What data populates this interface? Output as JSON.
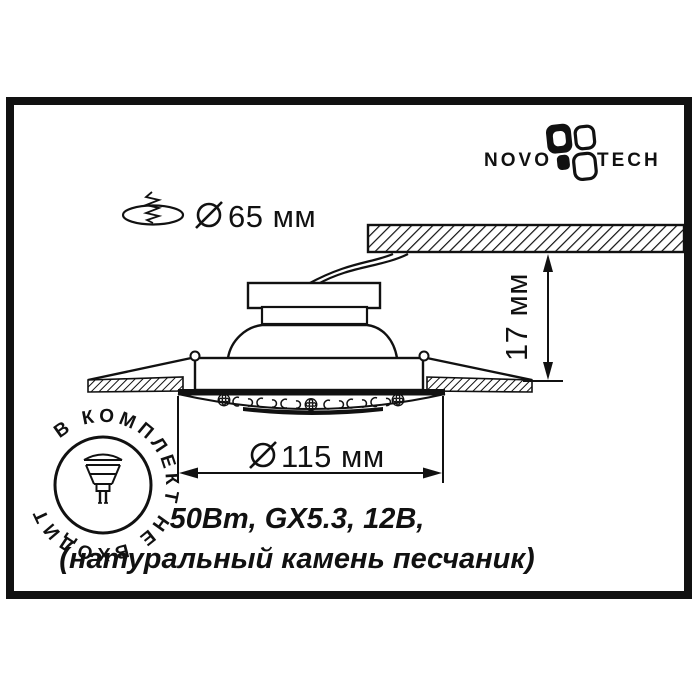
{
  "page": {
    "paper_color": "#ffffff",
    "ink_color": "#111111"
  },
  "brand": {
    "wordmark_left": "NOVO",
    "wordmark_right": "TECH",
    "logo_icon": "novotech-petals-icon"
  },
  "annotations": {
    "cutout_diameter_label": "65 мм",
    "recess_depth_label": "17 мм",
    "trim_diameter_label": "115 мм"
  },
  "stamp": {
    "ring_text": "В КОМПЛЕКТ НЕ ВХОДИТ",
    "center_icon": "mr16-lamp-icon"
  },
  "specs": {
    "line1": "50Вm, GX5.3, 12В,",
    "line2": "(натуральный камень песчаник)"
  },
  "icons": {
    "logo": "novotech-petals-icon",
    "ceiling_hole": "ceiling-hole-icon",
    "screw": "screw-spring-icon",
    "diameter_symbol": "diameter-symbol-icon",
    "lamp": "mr16-lamp-icon"
  }
}
